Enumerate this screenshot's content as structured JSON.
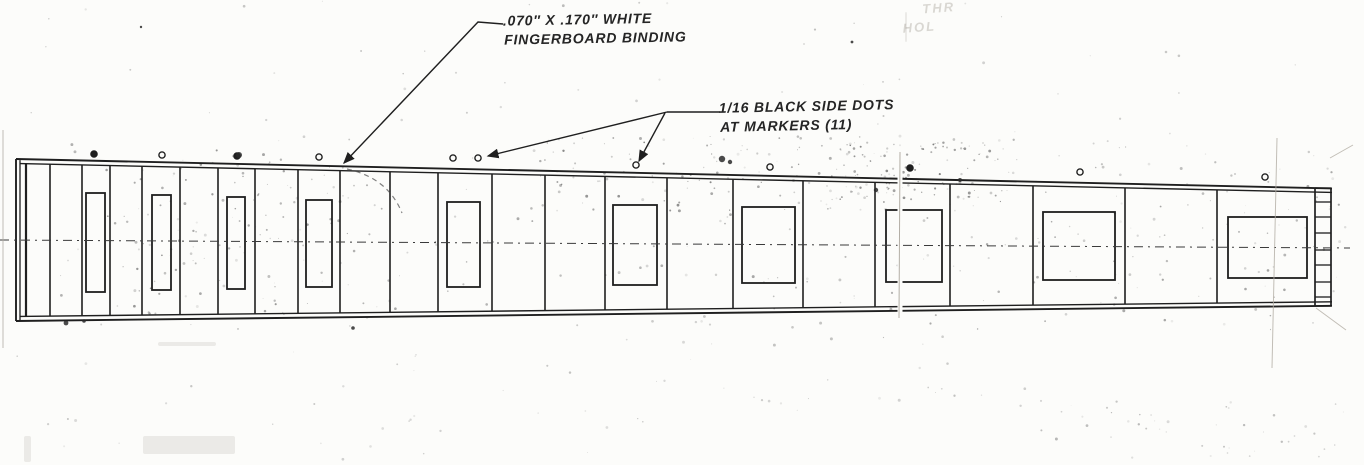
{
  "annotations": {
    "binding_note": {
      "line1": ".070″ X .170″ WHITE",
      "line2": "FINGERBOARD BINDING"
    },
    "side_dots_note": {
      "line1": "1/16 BLACK SIDE DOTS",
      "line2": "AT MARKERS (11)"
    },
    "corner_note": {
      "line1": "THR",
      "line2": "HOL"
    }
  },
  "colors": {
    "ink": "#1f1f1f",
    "paper": "#fcfcfa",
    "faint": "#b3aea5"
  },
  "diagram": {
    "outline": {
      "x_left": 16,
      "x_right": 1332,
      "top_left_y": 159,
      "top_right_y": 188.4,
      "bottom_left_y": 321,
      "bottom_right_y": 305.8,
      "binding_offset": 4.5
    },
    "left_edge_lines_x": [
      20,
      26
    ],
    "fret_positions_x": [
      50,
      82,
      110,
      142,
      180,
      218,
      255,
      298,
      340,
      390,
      438,
      492,
      545,
      605,
      667,
      733,
      803,
      875,
      950,
      1033,
      1125,
      1217
    ],
    "end_strip": {
      "x1": 1315,
      "x2": 1331,
      "cell_y": [
        188,
        202,
        217,
        233,
        250,
        265,
        282,
        297,
        306
      ]
    },
    "inlays": [
      [
        86,
        193,
        19,
        99
      ],
      [
        152,
        195,
        19,
        95
      ],
      [
        227,
        197,
        18,
        92
      ],
      [
        306,
        200,
        26,
        87
      ],
      [
        447,
        202,
        33,
        85
      ],
      [
        613,
        205,
        44,
        80
      ],
      [
        742,
        207,
        53,
        76
      ],
      [
        886,
        210,
        56,
        72
      ],
      [
        1043,
        212,
        72,
        68
      ],
      [
        1228,
        217,
        79,
        61
      ]
    ],
    "side_dots": [
      {
        "x": 94,
        "y": 154,
        "filled": true
      },
      {
        "x": 162,
        "y": 155,
        "filled": false
      },
      {
        "x": 237,
        "y": 156,
        "filled": true
      },
      {
        "x": 319,
        "y": 157,
        "filled": false
      },
      {
        "x": 453,
        "y": 158,
        "filled": false
      },
      {
        "x": 478,
        "y": 158,
        "filled": false
      },
      {
        "x": 636,
        "y": 165,
        "filled": false
      },
      {
        "x": 770,
        "y": 167,
        "filled": false
      },
      {
        "x": 910,
        "y": 168,
        "filled": true
      },
      {
        "x": 1080,
        "y": 172,
        "filled": false
      },
      {
        "x": 1265,
        "y": 177,
        "filled": false
      }
    ],
    "centerline": {
      "x1": 0,
      "y1": 240,
      "x2": 1350,
      "y2": 248
    },
    "leaders": {
      "binding": [
        [
          503,
          24
        ],
        [
          478,
          22
        ],
        [
          344,
          163
        ]
      ],
      "side_dots_main": [
        [
          720,
          112
        ],
        [
          667,
          112
        ]
      ],
      "side_dots_branch1": [
        [
          667,
          112
        ],
        [
          488,
          156
        ]
      ],
      "side_dots_branch2": [
        [
          665,
          113
        ],
        [
          639,
          161
        ]
      ]
    },
    "seam": {
      "x": 900,
      "y1": 150,
      "y2": 318
    },
    "creases": [
      [
        1277,
        138,
        1272,
        368
      ],
      [
        1316,
        308,
        1346,
        330
      ],
      [
        1330,
        158,
        1353,
        145
      ],
      [
        3,
        130,
        3,
        348
      ]
    ],
    "crease_curve": "M 347 169 Q 388 178 402 213",
    "smudges": [
      [
        239,
        155,
        3
      ],
      [
        722,
        159,
        3.2
      ],
      [
        730,
        162,
        2.2
      ],
      [
        66,
        323,
        2.4
      ],
      [
        84,
        321,
        1.8
      ],
      [
        353,
        328,
        1.8
      ],
      [
        852,
        42,
        1.4
      ],
      [
        141,
        27,
        1.2
      ],
      [
        960,
        180,
        2
      ],
      [
        876,
        190,
        2.2
      ]
    ],
    "smears": [
      [
        158,
        342,
        58,
        4
      ],
      [
        143,
        436,
        92,
        18
      ],
      [
        24,
        436,
        7,
        26
      ],
      [
        905,
        12,
        2,
        30
      ]
    ]
  }
}
